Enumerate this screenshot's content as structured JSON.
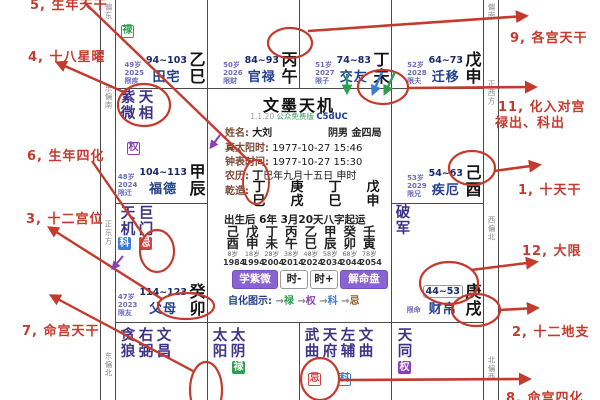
{
  "center": {
    "title": "文墨天机",
    "version": "1.1.20",
    "edition": "公众免费版",
    "code": "C5dUC",
    "name_label": "姓名:",
    "name_value": "大刘",
    "gender": "阴男",
    "bureau": "金四局",
    "solar_label": "真太阳时:",
    "solar_value": "1977-10-27  15:46",
    "clock_label": "钟表时间:",
    "clock_value": "1977-10-27  15:30",
    "lunar_label": "农历:",
    "lunar_stem": "丁",
    "lunar_rest": "巳年九月十五日 申时",
    "gan_label": "乾造:",
    "bazi_stems": [
      "丁",
      "庚",
      "丁",
      "戊"
    ],
    "bazi_branches": [
      "巳",
      "戌",
      "巳",
      "申"
    ],
    "qiyun": "出生后 6年 3月20天八字起运",
    "dayun_stems": [
      "己",
      "戊",
      "丁",
      "丙",
      "乙",
      "甲",
      "癸",
      "壬"
    ],
    "dayun_branches": [
      "酉",
      "申",
      "未",
      "午",
      "巳",
      "辰",
      "卯",
      "寅"
    ],
    "dayun_ages": [
      "8岁",
      "18岁",
      "28岁",
      "38岁",
      "48岁",
      "58岁",
      "68岁",
      "78岁"
    ],
    "dayun_years": [
      "1984",
      "1994",
      "2004",
      "2014",
      "2024",
      "2034",
      "2044",
      "2054"
    ],
    "btn_learn": "学紫微",
    "btn_minus": "时-",
    "btn_plus": "时+",
    "btn_solve": "解命盘",
    "legend_label": "自化图示:",
    "legend_arrow": "→",
    "legend_lu": "禄",
    "legend_quan": "权",
    "legend_ke": "科",
    "legend_ji": "忌"
  },
  "palaces": {
    "si": {
      "badge": "禄",
      "age": "49岁",
      "year": "2025",
      "limit": "限疾",
      "range": "94~103",
      "name": "田宅",
      "stem": "乙",
      "branch": "巳"
    },
    "wu": {
      "age": "50岁",
      "year": "2026",
      "limit": "限财",
      "range": "84~93",
      "name": "官禄",
      "stem": "丙",
      "branch": "午"
    },
    "wei": {
      "age": "51岁",
      "year": "2027",
      "limit": "限子",
      "range": "74~83",
      "name": "交友",
      "stem": "丁",
      "branch": "未"
    },
    "shen": {
      "age": "52岁",
      "year": "2028",
      "limit": "限夫",
      "range": "64~73",
      "name": "迁移",
      "stem": "戊",
      "branch": "申"
    },
    "chen": {
      "stars": [
        "紫微",
        "天相"
      ],
      "badge": "权",
      "age": "48岁",
      "year": "2024",
      "limit": "限迁",
      "range": "104~113",
      "name": "福德",
      "stem": "甲",
      "branch": "辰"
    },
    "you": {
      "age": "53岁",
      "year": "2029",
      "limit": "限兄",
      "range": "54~63",
      "name": "疾厄",
      "stem": "己",
      "branch": "酉"
    },
    "mao": {
      "stars": [
        "天机",
        "巨门"
      ],
      "badges": [
        "科",
        "忌"
      ],
      "age": "47岁",
      "year": "2023",
      "limit": "限友",
      "range": "114~123",
      "name": "父母",
      "stem": "癸",
      "branch": "卯"
    },
    "xu": {
      "stars": [
        "破军"
      ],
      "limit": "限命",
      "range": "44~53",
      "name": "财帛",
      "stem": "庚",
      "branch": "戌"
    },
    "yin": {
      "stars": [
        "贪狼",
        "右弼",
        "文昌"
      ]
    },
    "chou": {
      "stars": [
        "太阳",
        "太阴"
      ],
      "badge": "禄"
    },
    "zi": {
      "stars": [
        "武曲",
        "天府",
        "左辅",
        "文曲"
      ],
      "badges": [
        "忌",
        "科"
      ]
    },
    "hai": {
      "stars": [
        "天同"
      ],
      "badge": "权"
    }
  },
  "sidebar_left": [
    "偏东",
    "东偏南",
    "正东方",
    "东偏北"
  ],
  "sidebar_right": [
    "偏南",
    "正西方",
    "西偏北",
    "北偏西"
  ],
  "annotations": {
    "a1": "1, 十天干",
    "a2": "2, 十二地支",
    "a3": "3, 十二宫位",
    "a4": "4, 十八星曜",
    "a5": "5, 生年天干",
    "a6": "6, 生年四化",
    "a7": "7, 命宫天干",
    "a8": "8, 命宫四化",
    "a9": "9, 各宫天干",
    "a11a": "11, 化入对宫",
    "a11b": "禄出、科出",
    "a12": "12, 大限"
  },
  "colors": {
    "annotation_red": "#c43b2e",
    "lu_green": "#2f9e4f",
    "quan_purple": "#8a3fb5",
    "ke_blue": "#3a7bd5",
    "ji_red": "#cc4444",
    "button_purple": "#8a63d2",
    "palace_navy": "#23418f",
    "star_indigo": "#3d3488"
  }
}
